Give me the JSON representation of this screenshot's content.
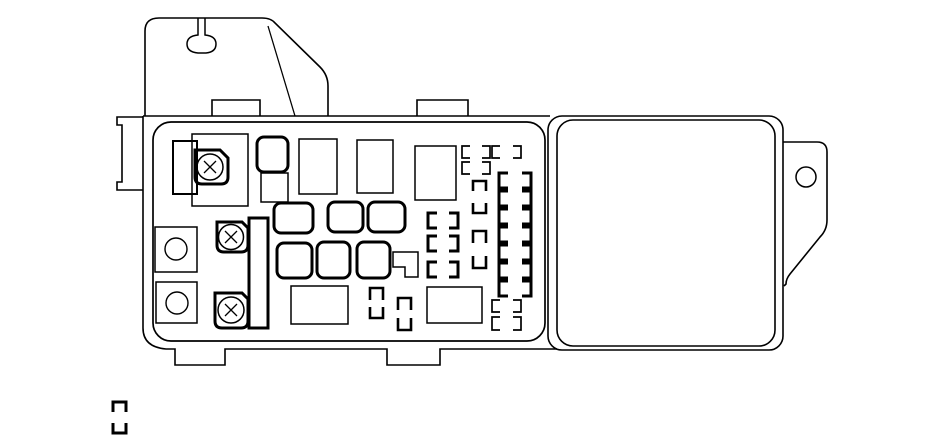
{
  "meta": {
    "description": "Black-and-white line-art diagram of an automotive under-hood fuse/relay box with mounting bracket, fuse panel and side cover"
  },
  "canvas": {
    "w": 950,
    "h": 447,
    "bg": "#ffffff",
    "stroke": "#000000"
  },
  "icons": {
    "screw": "circled-x-screw-head",
    "mount_hole": "circle",
    "fuse_slot": "bracket-pair"
  },
  "diagram": {
    "shapes": [
      {
        "name": "housing-top-edge",
        "t": "path",
        "sw": 1.6,
        "d": "M143,116 L550,116"
      },
      {
        "name": "housing-left-bottom-edge",
        "t": "path",
        "sw": 1.6,
        "d": "M143,116 L143,328 Q143,347 166,349 L175,349 L175,365 L225,365 L225,349 L387,349 L387,365 L440,365 L440,349 L557,349"
      },
      {
        "name": "mounting-bracket-outline",
        "t": "path",
        "sw": 1.6,
        "d": "M145,116 L145,31 Q145,18 159,18 L262,18 Q271,18 275,23 L320,67 Q328,75 328,86 L328,116"
      },
      {
        "name": "bracket-keyhole-slot",
        "t": "path",
        "sw": 1.5,
        "d": "M198,18 L198,35 Q187,36 187,44 Q187,52 198,53 L206,53 Q216,52 216,44 Q216,36 205,35 L205,18"
      },
      {
        "name": "bracket-fold-line",
        "t": "path",
        "sw": 1.3,
        "d": "M268,26 L295,116"
      },
      {
        "name": "left-mount-bracket",
        "t": "path",
        "sw": 1.6,
        "d": "M143,117 L117,117 L117,125 L122,125 L122,182 L117,182 L117,190 L143,190"
      },
      {
        "name": "housing-top-tab-left",
        "t": "path",
        "sw": 1.6,
        "d": "M212,116 L212,100 L260,100 L260,116"
      },
      {
        "name": "housing-top-tab-right",
        "t": "path",
        "sw": 1.6,
        "d": "M417,116 L417,100 L468,100 L468,116"
      },
      {
        "name": "fuse-panel-body",
        "t": "rect",
        "x": 153,
        "y": 122,
        "w": 392,
        "h": 219,
        "r": 18,
        "sw": 1.7
      },
      {
        "name": "cover-outer",
        "t": "rect",
        "x": 548,
        "y": 116,
        "w": 235,
        "h": 234,
        "r": 14,
        "sw": 1.6
      },
      {
        "name": "cover-inner",
        "t": "rect",
        "x": 557,
        "y": 120,
        "w": 218,
        "h": 226,
        "r": 16,
        "sw": 1.6
      },
      {
        "name": "cover-mount-tab",
        "t": "path",
        "sw": 1.6,
        "d": "M783,142 L817,142 Q827,142 827,152 L827,220 Q827,230 820,237 L790,274 Q786,279 786,284 L784,286"
      },
      {
        "name": "cover-tab-hole",
        "t": "circle",
        "cx": 806,
        "cy": 177,
        "r": 10,
        "sw": 1.5
      },
      {
        "name": "relay-rect-a",
        "t": "rect",
        "x": 173,
        "y": 141,
        "w": 24,
        "h": 53,
        "sw": 2
      },
      {
        "name": "relay-rect-b",
        "t": "rect",
        "x": 192,
        "y": 134,
        "w": 56,
        "h": 72,
        "sw": 1.5
      },
      {
        "name": "terminal-square-1",
        "t": "rect",
        "x": 155,
        "y": 227,
        "w": 42,
        "h": 45,
        "sw": 1.5
      },
      {
        "name": "terminal-hole-1",
        "t": "circle",
        "cx": 176,
        "cy": 249,
        "r": 11,
        "sw": 1.4
      },
      {
        "name": "terminal-square-2",
        "t": "rect",
        "x": 156,
        "y": 282,
        "w": 41,
        "h": 41,
        "sw": 1.5
      },
      {
        "name": "terminal-hole-2",
        "t": "circle",
        "cx": 177,
        "cy": 303,
        "r": 11,
        "sw": 1.4
      },
      {
        "name": "screw-block-1",
        "t": "path",
        "sw": 3,
        "d": "M195,150 L220,150 L228,158 L228,177 Q228,184 221,184 L202,184 Q195,184 195,177 Z"
      },
      {
        "name": "screw-head-1",
        "t": "circle",
        "cx": 210,
        "cy": 167,
        "r": 13,
        "sw": 1.5
      },
      {
        "name": "screw-cross-1",
        "t": "path",
        "sw": 1.3,
        "d": "M204,161 L216,173 M216,161 L204,173"
      },
      {
        "name": "screw-block-2",
        "t": "path",
        "sw": 3,
        "d": "M217,222 L242,222 L248,228 L248,245 Q248,252 241,252 L224,252 Q217,252 217,245 Z"
      },
      {
        "name": "screw-head-2",
        "t": "circle",
        "cx": 231,
        "cy": 237,
        "r": 12.5,
        "sw": 1.5
      },
      {
        "name": "screw-cross-2",
        "t": "path",
        "sw": 1.3,
        "d": "M225,231 L237,243 M237,231 L225,243"
      },
      {
        "name": "screw-block-3",
        "t": "path",
        "sw": 3,
        "d": "M215,293 L242,293 L248,299 L248,321 Q248,328 241,328 L222,328 Q215,328 215,321 Z"
      },
      {
        "name": "screw-head-3",
        "t": "circle",
        "cx": 231,
        "cy": 310,
        "r": 13,
        "sw": 1.5
      },
      {
        "name": "screw-cross-3",
        "t": "path",
        "sw": 1.3,
        "d": "M225,304 L237,316 M237,304 L225,316"
      },
      {
        "name": "busbar-vertical",
        "t": "rect",
        "x": 249,
        "y": 218,
        "w": 19,
        "h": 110,
        "sw": 3
      },
      {
        "name": "fuse-square-d",
        "t": "rect",
        "x": 257,
        "y": 137,
        "w": 31,
        "h": 35,
        "r": 7,
        "sw": 3
      },
      {
        "name": "fuse-square-e",
        "t": "rect",
        "x": 261,
        "y": 173,
        "w": 27,
        "h": 29,
        "sw": 1.5
      },
      {
        "name": "relay-rect-f",
        "t": "rect",
        "x": 299,
        "y": 139,
        "w": 38,
        "h": 55,
        "sw": 1.5
      },
      {
        "name": "relay-rect-g",
        "t": "rect",
        "x": 357,
        "y": 140,
        "w": 36,
        "h": 53,
        "sw": 1.5
      },
      {
        "name": "relay-rect-h",
        "t": "rect",
        "x": 415,
        "y": 146,
        "w": 41,
        "h": 54,
        "sw": 1.5
      },
      {
        "name": "fuse-a1",
        "t": "rect",
        "x": 274,
        "y": 203,
        "w": 39,
        "h": 30,
        "r": 7,
        "sw": 3
      },
      {
        "name": "fuse-a2",
        "t": "rect",
        "x": 328,
        "y": 202,
        "w": 35,
        "h": 30,
        "r": 7,
        "sw": 3
      },
      {
        "name": "fuse-a3",
        "t": "rect",
        "x": 368,
        "y": 202,
        "w": 37,
        "h": 30,
        "r": 7,
        "sw": 3
      },
      {
        "name": "fuse-b1",
        "t": "rect",
        "x": 277,
        "y": 243,
        "w": 35,
        "h": 35,
        "r": 7,
        "sw": 3
      },
      {
        "name": "fuse-b2",
        "t": "rect",
        "x": 317,
        "y": 242,
        "w": 33,
        "h": 36,
        "r": 7,
        "sw": 3
      },
      {
        "name": "fuse-b3",
        "t": "rect",
        "x": 357,
        "y": 242,
        "w": 33,
        "h": 36,
        "r": 7,
        "sw": 3
      },
      {
        "name": "flag-connector",
        "t": "path",
        "sw": 1.5,
        "d": "M393,252 L418,252 L418,277 L405,277 L405,267 L393,267 Z"
      },
      {
        "name": "relay-rect-r1",
        "t": "rect",
        "x": 291,
        "y": 286,
        "w": 57,
        "h": 38,
        "sw": 1.5
      },
      {
        "name": "relay-rect-r2",
        "t": "rect",
        "x": 427,
        "y": 287,
        "w": 55,
        "h": 36,
        "sw": 1.5
      },
      {
        "name": "fuse-slot-p1",
        "t": "path",
        "sw": 1.7,
        "d": "M470,146 L462,146 L462,158 L470,158 M482,146 L490,146 L490,158 L482,158"
      },
      {
        "name": "fuse-slot-p2",
        "t": "path",
        "sw": 1.7,
        "d": "M500,146 L492,146 L492,158 L500,158 M513,146 L521,146 L521,158 L513,158"
      },
      {
        "name": "fuse-slot-p3",
        "t": "path",
        "sw": 1.7,
        "d": "M470,162 L462,162 L462,174 L470,174 M482,162 L490,162 L490,174 L482,174"
      },
      {
        "name": "fuse-slot-p4",
        "t": "path",
        "sw": 1.7,
        "d": "M500,300 L492,300 L492,312 L500,312 M513,300 L521,300 L521,312 L513,312"
      },
      {
        "name": "fuse-slot-p5",
        "t": "path",
        "sw": 1.7,
        "d": "M500,317 L492,317 L492,330 L500,330 M513,317 L521,317 L521,330 L513,330"
      },
      {
        "name": "fuse-slot-l1",
        "t": "path",
        "sw": 3,
        "d": "M437,213 L428,213 L428,228 L437,228 M449,213 L458,213 L458,228 L449,228"
      },
      {
        "name": "fuse-slot-l2",
        "t": "path",
        "sw": 3,
        "d": "M437,236 L428,236 L428,251 L437,251 M449,236 L458,236 L458,251 L449,251"
      },
      {
        "name": "fuse-slot-l3",
        "t": "path",
        "sw": 3,
        "d": "M437,262 L428,262 L428,277 L437,277 M449,262 L458,262 L458,277 L449,277"
      },
      {
        "name": "fuse-slot-rc1",
        "t": "path",
        "sw": 3,
        "d": "M508,173 L499,173 L499,188 L508,188 M522,173 L531,173 L531,188 L522,188"
      },
      {
        "name": "fuse-slot-rc2",
        "t": "path",
        "sw": 3,
        "d": "M508,191 L499,191 L499,206 L508,206 M522,191 L531,191 L531,206 L522,206"
      },
      {
        "name": "fuse-slot-rc3",
        "t": "path",
        "sw": 3,
        "d": "M508,209 L499,209 L499,224 L508,224 M522,209 L531,209 L531,224 L522,224"
      },
      {
        "name": "fuse-slot-rc4",
        "t": "path",
        "sw": 3,
        "d": "M508,227 L499,227 L499,242 L508,242 M522,227 L531,227 L531,242 L522,242"
      },
      {
        "name": "fuse-slot-rc5",
        "t": "path",
        "sw": 3,
        "d": "M508,245 L499,245 L499,260 L508,260 M522,245 L531,245 L531,260 L522,260"
      },
      {
        "name": "fuse-slot-rc6",
        "t": "path",
        "sw": 3,
        "d": "M508,263 L499,263 L499,278 L508,278 M522,263 L531,263 L531,278 L522,278"
      },
      {
        "name": "fuse-slot-rc7",
        "t": "path",
        "sw": 3,
        "d": "M508,281 L499,281 L499,296 L508,296 M522,281 L531,281 L531,296 L522,296"
      },
      {
        "name": "fuse-slot-v1",
        "t": "path",
        "sw": 2.6,
        "d": "M473,191 L473,181 L486,181 L486,191 M473,203 L473,213 L486,213 L486,203"
      },
      {
        "name": "fuse-slot-v2",
        "t": "path",
        "sw": 2.6,
        "d": "M473,243 L473,231 L486,231 L486,243 M473,256 L473,268 L486,268 L486,256"
      },
      {
        "name": "fuse-slot-v3",
        "t": "path",
        "sw": 2.6,
        "d": "M370,300 L370,288 L383,288 L383,300 M370,307 L370,318 L383,318 L383,307"
      },
      {
        "name": "fuse-slot-v4",
        "t": "path",
        "sw": 2.6,
        "d": "M398,310 L398,298 L411,298 L411,310 M398,318 L398,330 L411,330 L411,318"
      },
      {
        "name": "fuse-slot-external",
        "t": "path",
        "sw": 3,
        "d": "M113,412 L113,402 L126,402 L126,412 M113,423 L113,433 L126,433 L126,423"
      }
    ]
  }
}
